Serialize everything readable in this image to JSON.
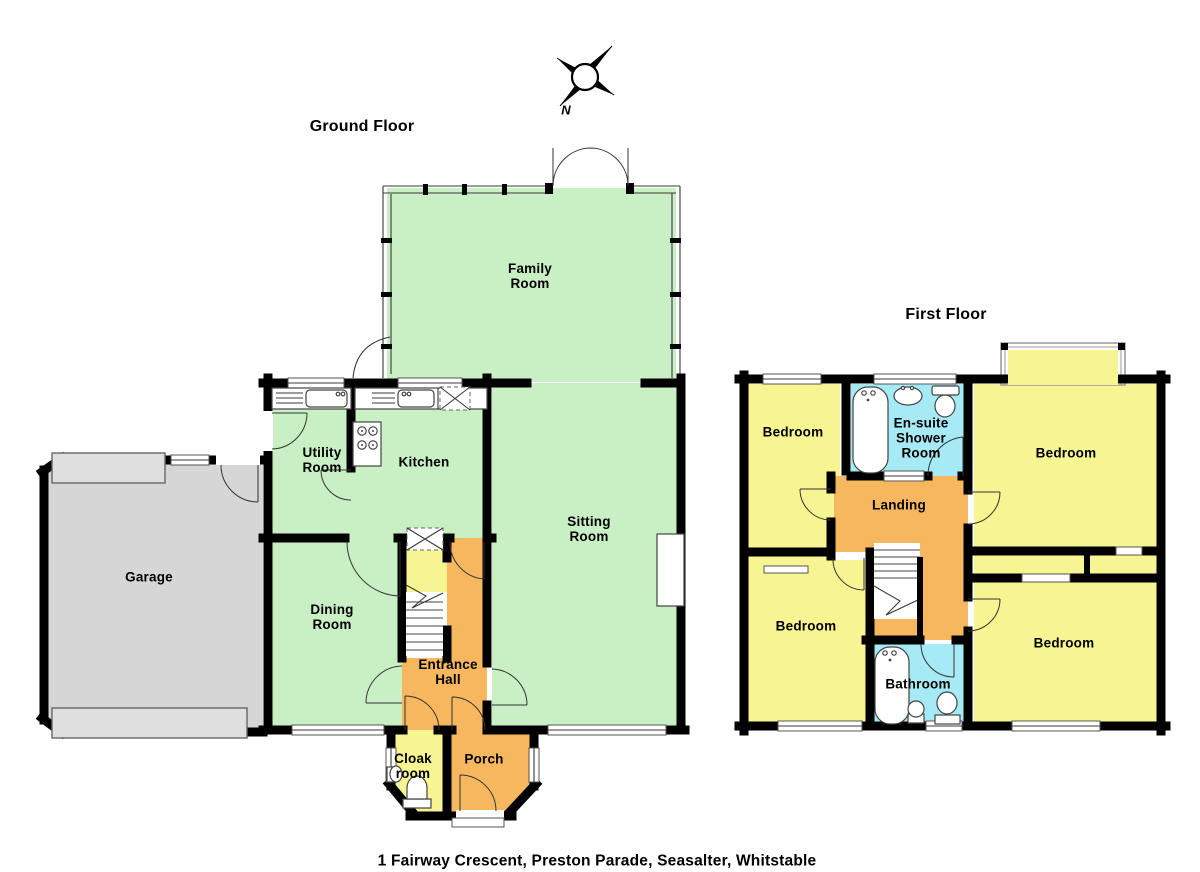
{
  "titles": {
    "ground_floor": "Ground Floor",
    "first_floor": "First Floor"
  },
  "caption": "1 Fairway Crescent, Preston Parade, Seasalter, Whitstable",
  "compass": {
    "label": "N"
  },
  "colors": {
    "living": "#c9efc4",
    "bedroom": "#f7f492",
    "circulation": "#f6b75f",
    "bathroom": "#a5eaf4",
    "garage": "#d6d6d6",
    "garage_door": "#dfdfdf",
    "wall": "#000000"
  },
  "ground_floor": {
    "rooms": [
      {
        "name": "family-room",
        "label": "Family\nRoom"
      },
      {
        "name": "utility-room",
        "label": "Utility\nRoom"
      },
      {
        "name": "kitchen",
        "label": "Kitchen"
      },
      {
        "name": "garage",
        "label": "Garage"
      },
      {
        "name": "dining-room",
        "label": "Dining\nRoom"
      },
      {
        "name": "sitting-room",
        "label": "Sitting\nRoom"
      },
      {
        "name": "entrance-hall",
        "label": "Entrance\nHall"
      },
      {
        "name": "cloak-room",
        "label": "Cloak\nroom"
      },
      {
        "name": "porch",
        "label": "Porch"
      }
    ]
  },
  "first_floor": {
    "rooms": [
      {
        "name": "bedroom-top-left",
        "label": "Bedroom"
      },
      {
        "name": "ensuite-shower-room",
        "label": "En-suite\nShower\nRoom"
      },
      {
        "name": "bedroom-top-right",
        "label": "Bedroom"
      },
      {
        "name": "landing",
        "label": "Landing"
      },
      {
        "name": "bedroom-bottom-left",
        "label": "Bedroom"
      },
      {
        "name": "bathroom",
        "label": "Bathroom"
      },
      {
        "name": "bedroom-bottom-right",
        "label": "Bedroom"
      }
    ]
  }
}
